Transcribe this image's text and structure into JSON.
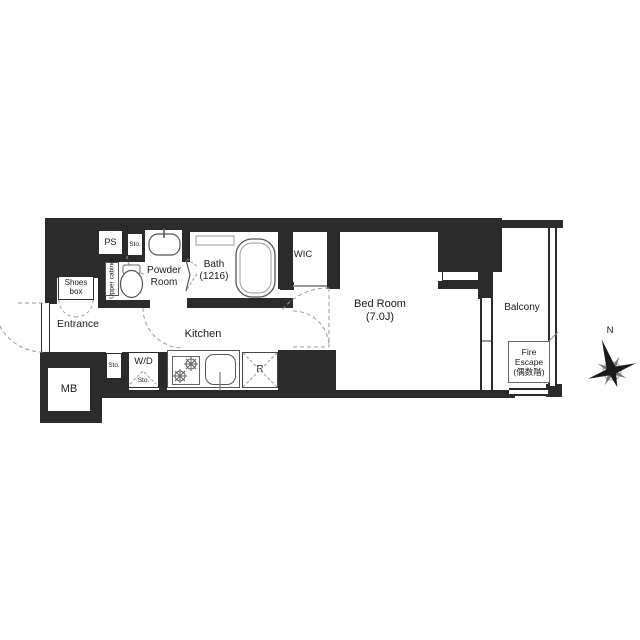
{
  "colors": {
    "wall": "#2b2b2b",
    "background": "#ffffff",
    "fixture_line": "#555555",
    "dashed_line": "#999999",
    "text": "#1a1a1a"
  },
  "labels": {
    "ps": "PS",
    "sto_top": "Sto.",
    "upper_cabinet": "Upper cabinet",
    "powder_room": "Powder\nRoom",
    "bath": "Bath\n(1216)",
    "wic": "WIC",
    "shoes_box": "Shoes\nbox",
    "entrance": "Entrance",
    "mb": "MB",
    "kitchen": "Kitchen",
    "sto_bottom": "Sto.",
    "wd": "W/D",
    "wd_sto": "Sto.",
    "refrigerator": "R",
    "bedroom": "Bed Room\n(7.0J)",
    "balcony": "Balcony",
    "fire_escape": "Fire\nEscape\n(偶数階)",
    "compass_north": "N"
  }
}
